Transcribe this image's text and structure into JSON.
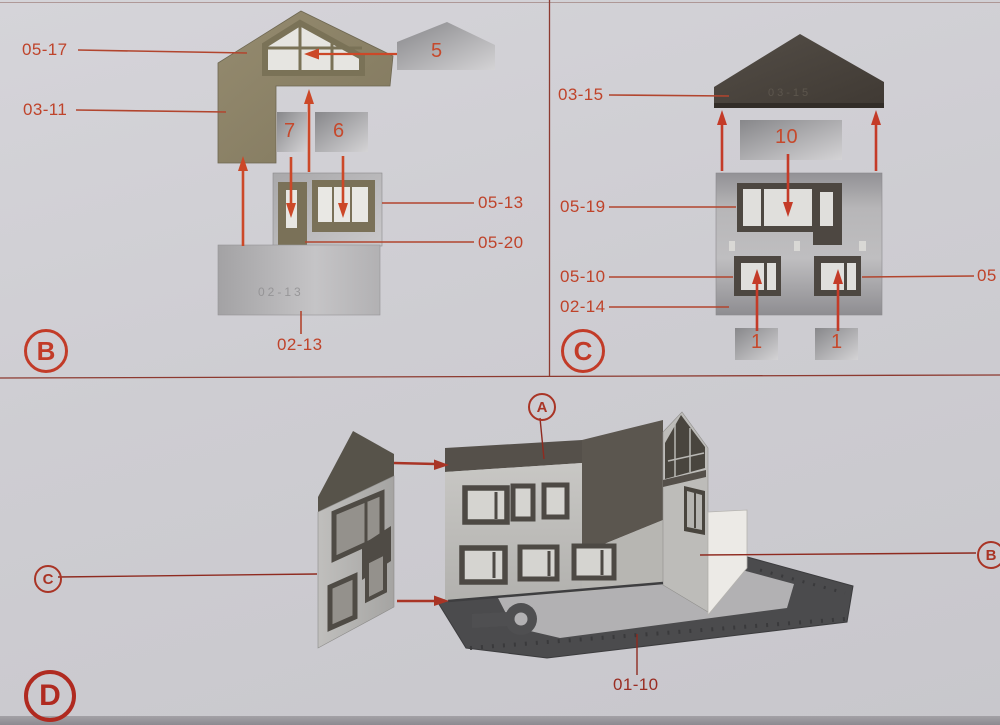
{
  "page": {
    "background": "#cfced3",
    "divider_color": "#8d3a30",
    "accent_orange": "#bf432a",
    "accent_dark_red": "#9a2c22"
  },
  "section_b": {
    "section_letter": "B",
    "labels": {
      "gable_window": "05-17",
      "gable_wall": "03-11",
      "window_frame": "05-13",
      "door_frame": "05-20",
      "base_strip": "02-13"
    },
    "pieces": {
      "roof_print": "5",
      "door_print": "7",
      "window_print": "6"
    },
    "embossed_base": "02-13"
  },
  "section_c": {
    "section_letter": "C",
    "labels": {
      "roof": "03-15",
      "upper_window_frame": "05-19",
      "lower_window_frame": "05-10",
      "wall": "02-14",
      "right_edge": "05"
    },
    "pieces": {
      "wall_print": "10",
      "left_window_print": "1",
      "right_window_print": "1"
    },
    "embossed_roof": "03-15"
  },
  "section_d": {
    "section_letter": "D",
    "callouts": {
      "front_wall": "A",
      "left_wall": "C",
      "right_wall": "B"
    },
    "labels": {
      "base_plate": "01-10"
    }
  }
}
